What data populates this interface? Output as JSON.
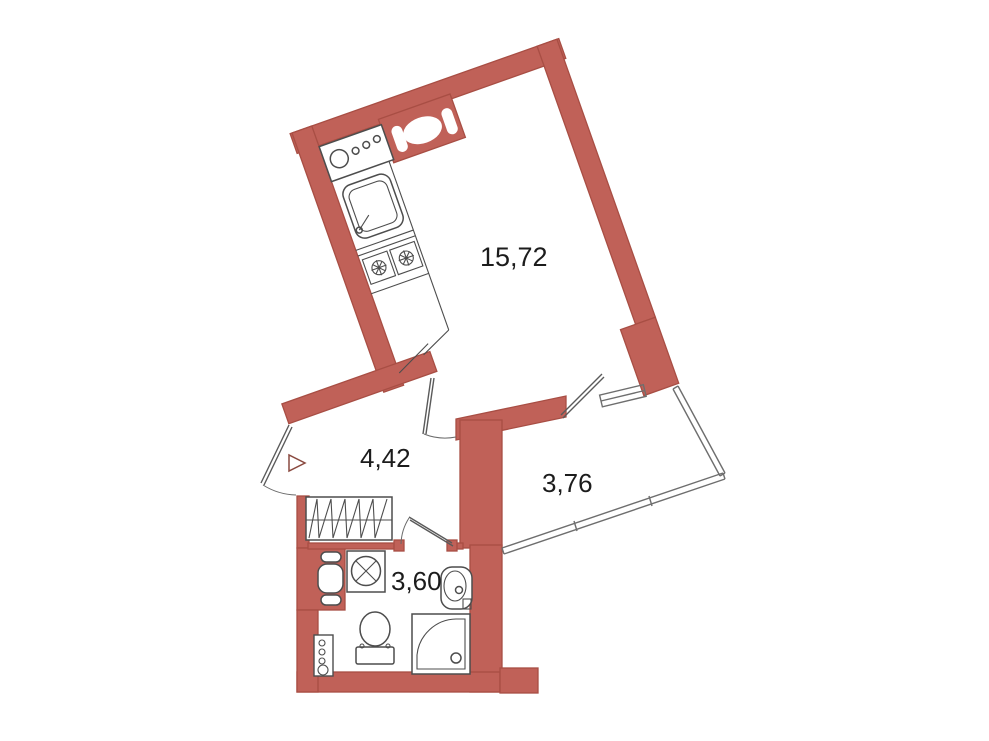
{
  "colors": {
    "wall_fill": "#c06158",
    "wall_stroke": "#a84e44",
    "line": "#4d4d4d",
    "glass": "#6e6e6e",
    "label": "#1c1c1c",
    "bg": "#ffffff"
  },
  "plan": {
    "type": "apartment-floor-plan",
    "rooms": [
      {
        "name": "living-room-kitchen",
        "area": "15,72"
      },
      {
        "name": "hallway",
        "area": "4,42"
      },
      {
        "name": "loggia",
        "area": "3,76"
      },
      {
        "name": "bathroom",
        "area": "3,60"
      }
    ],
    "fixtures": {
      "kitchen": [
        "washing-machine-panel",
        "vent-shaft",
        "kitchen-sink",
        "cooktop-2-burner",
        "counter-break"
      ],
      "bathroom": [
        "washing-machine",
        "towel-dryer",
        "toilet",
        "wash-basin",
        "shower-tray",
        "plumbing-riser"
      ],
      "hallway": [
        "wardrobe",
        "entrance-direction-arrow"
      ],
      "loggia": [
        "glazing"
      ]
    }
  }
}
